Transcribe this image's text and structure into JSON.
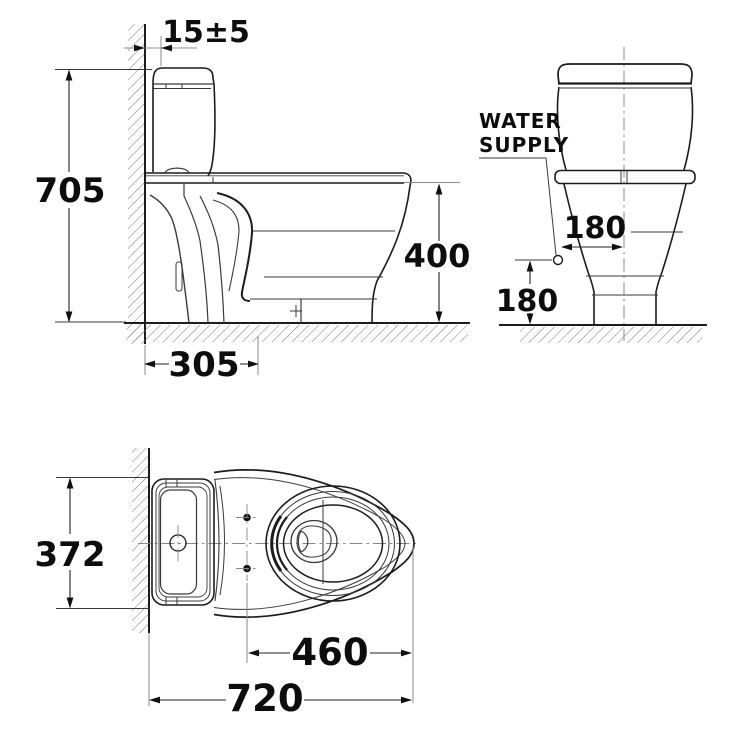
{
  "page": {
    "background": "#ffffff",
    "line_color": "#1c1c1c"
  },
  "views": {
    "side_view": {
      "name": "side elevation",
      "dimensions": {
        "wall_gap": "15±5",
        "overall_height": "705",
        "rim_height": "400",
        "outlet_from_wall": "305"
      }
    },
    "front_view": {
      "name": "front elevation",
      "labels": {
        "water_supply_line1": "WATER",
        "water_supply_line2": "SUPPLY"
      },
      "dimensions": {
        "supply_to_center": "180",
        "supply_height": "180"
      }
    },
    "top_view": {
      "name": "plan view",
      "dimensions": {
        "overall_width": "372",
        "bolt_line_to_front": "460",
        "overall_depth": "720"
      }
    }
  }
}
